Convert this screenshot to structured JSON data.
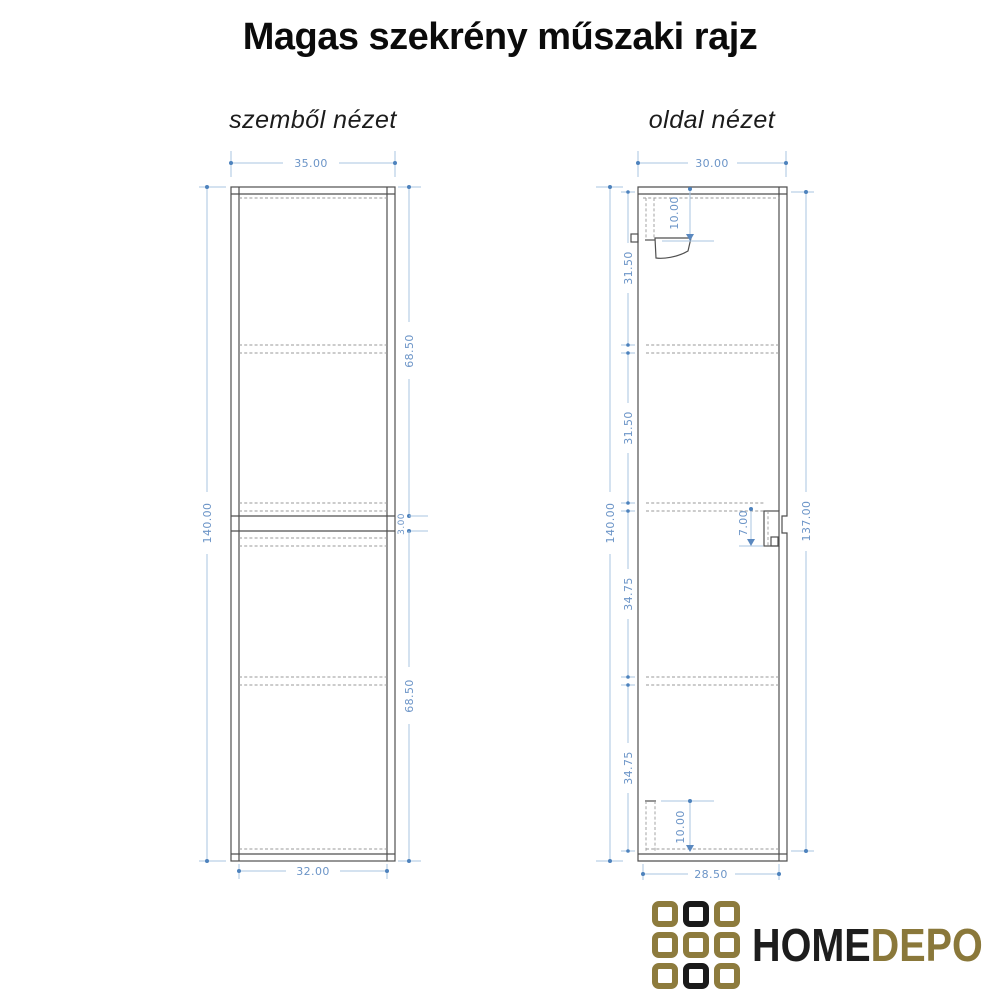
{
  "title": "Magas szekrény műszaki rajz",
  "front": {
    "label": "szemből nézet",
    "dims": {
      "top_width": "35.00",
      "height": "140.00",
      "upper_section": "68.50",
      "gap": "3.00",
      "lower_section": "68.50",
      "bottom_width": "32.00"
    }
  },
  "side": {
    "label": "oldal nézet",
    "dims": {
      "top_width": "30.00",
      "height": "140.00",
      "section_1": "31.50",
      "section_2": "31.50",
      "section_3": "34.75",
      "section_4": "34.75",
      "interior_height": "137.00",
      "top_detail": "10.00",
      "mid_detail": "7.00",
      "bottom_detail": "10.00",
      "bottom_width": "28.50"
    }
  },
  "logo": {
    "home": "HOME",
    "depo": "DEPO",
    "colors": {
      "gold": "#8d7b3d",
      "black": "#1a1a1a"
    },
    "grid_pattern": [
      "gold",
      "black",
      "gold",
      "gold",
      "gold",
      "gold",
      "gold",
      "black",
      "gold"
    ]
  },
  "colors": {
    "dimension_line": "#a9c5e1",
    "dimension_text": "#6b94c7",
    "drawing_line": "#4f4f4f"
  }
}
